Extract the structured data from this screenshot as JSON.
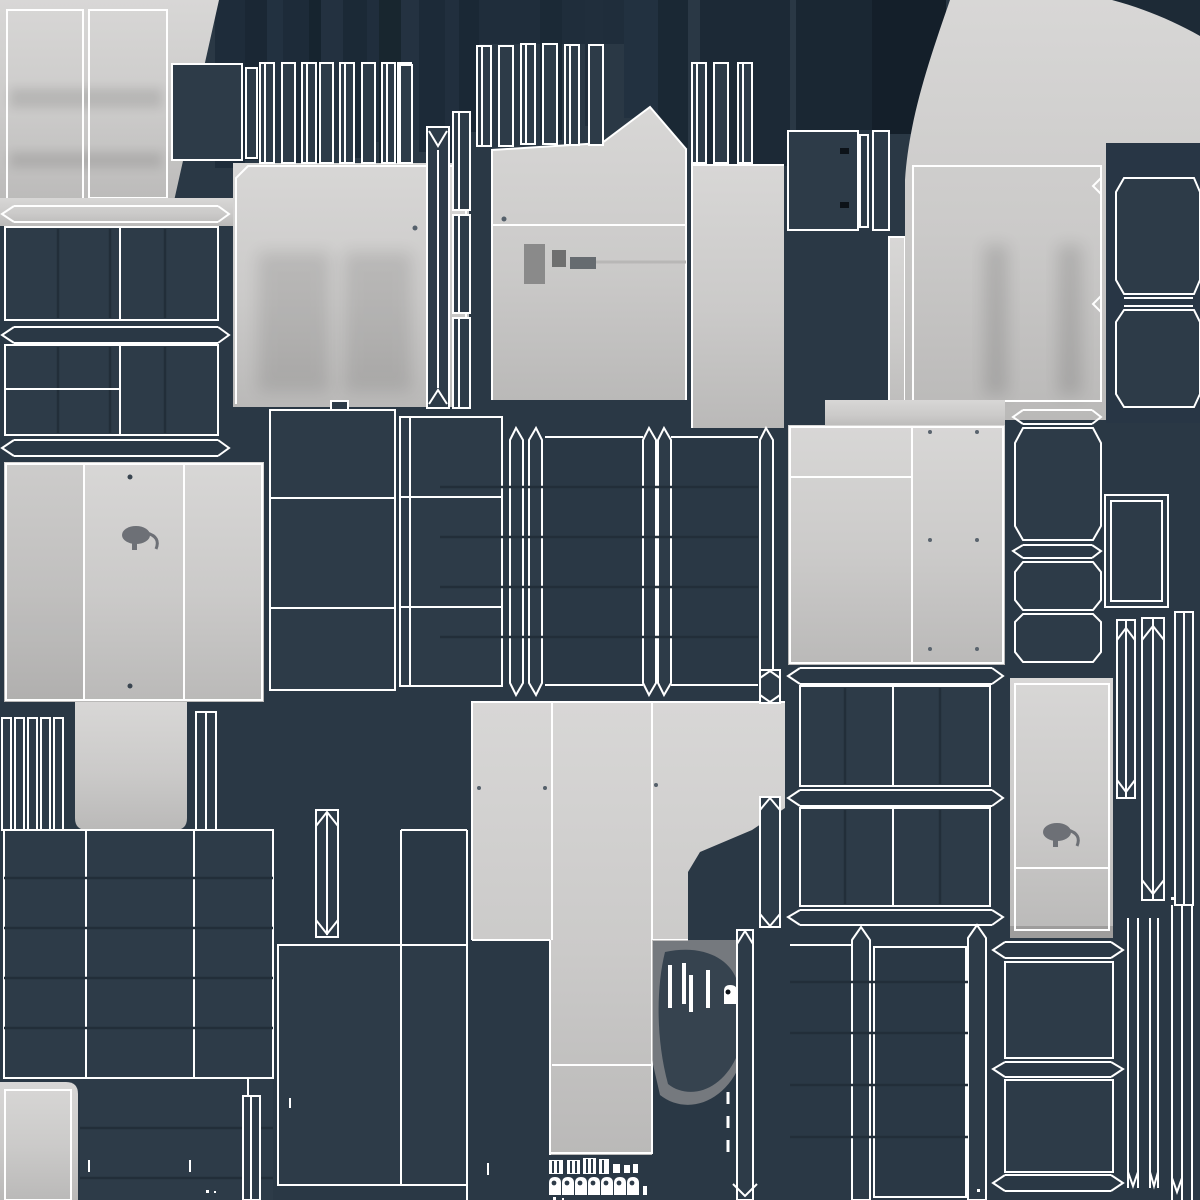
{
  "scene": {
    "label": "uv-texture-atlas-sheet"
  },
  "colors": {
    "background": "#2a3845",
    "background_deep": "#1b2834",
    "background_deepest": "#141f2a",
    "panel_dark": "#2d3b48",
    "panel_line": "#222e39",
    "wireframe": "#ffffff",
    "island_light_hi": "#d8d7d6",
    "island_light_mid": "#cbcac9",
    "island_light_lo": "#bab9b8",
    "shadow_gray": "#9e9d9c",
    "hardware_gray": "#6d7076",
    "black_mark": "#0c1218"
  },
  "islands": {
    "door_panels_top_left": 2,
    "cabinet_side_panels": 4,
    "arched_front_panel": 1,
    "curved_swoosh_band": 1,
    "drawer_grid_panels": 6,
    "slat_strip_groups": 4,
    "beveled_frame_boxes": 8,
    "pillar_strips_with_arrows": 10
  },
  "icons": {
    "knob_handle_top_view": 2,
    "keyhole_lock_plate": 1,
    "hinge_chip_plates": 3,
    "striped_vent_chips": 4,
    "rounded_tag_caps": 7,
    "black_fastener_marks": 2,
    "screw_dots": 12
  }
}
